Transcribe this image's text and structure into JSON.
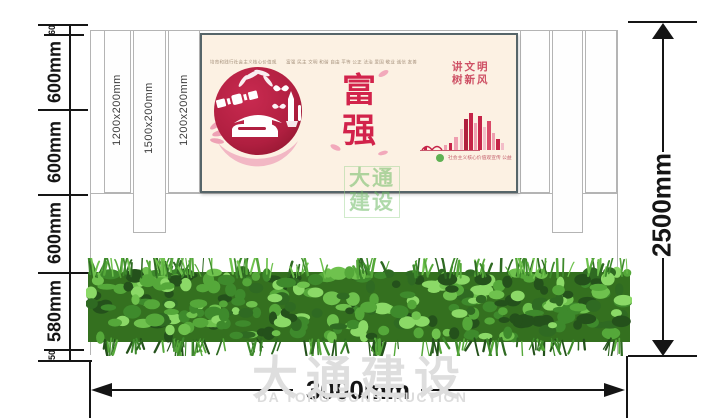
{
  "drawing": {
    "dims": {
      "left_segments": [
        {
          "label": "60"
        },
        {
          "label": "600mm"
        },
        {
          "label": "600mm"
        },
        {
          "label": "600mm"
        },
        {
          "label": "580mm"
        },
        {
          "label": "50"
        }
      ],
      "right_total": "2500mm",
      "bottom_total": "3000mm"
    },
    "columns": [
      {
        "label": "1200x200mm"
      },
      {
        "label": "1500x200mm"
      },
      {
        "label": "1200x200mm"
      }
    ],
    "poster": {
      "slogan_top": "培育和践行社会主义核心价值观　　富强  民主  文明  和谐  自由  平等  公正  法治  爱国  敬业  诚信  友善",
      "main_chars": [
        "富",
        "强"
      ],
      "side_lines": [
        "讲文明",
        "树新风"
      ],
      "footer_note": "社会主义核心价值观宣传 公益"
    },
    "watermark": {
      "cn": "大通建设",
      "en": "DA TONG CONSTRUCTION",
      "stamp_lines": [
        "大通",
        "建设"
      ]
    },
    "colors": {
      "poster_bg": "#fcf1e3",
      "poster_border": "#566569",
      "emblem_red": "#b52247",
      "accent_red": "#d2234b",
      "pink": "#f2a9bb",
      "stamp_green": "#79bd6d",
      "dim_black": "#151515",
      "watermark_gray": "#dedede",
      "hedge_green": "#3e7c2a"
    }
  }
}
